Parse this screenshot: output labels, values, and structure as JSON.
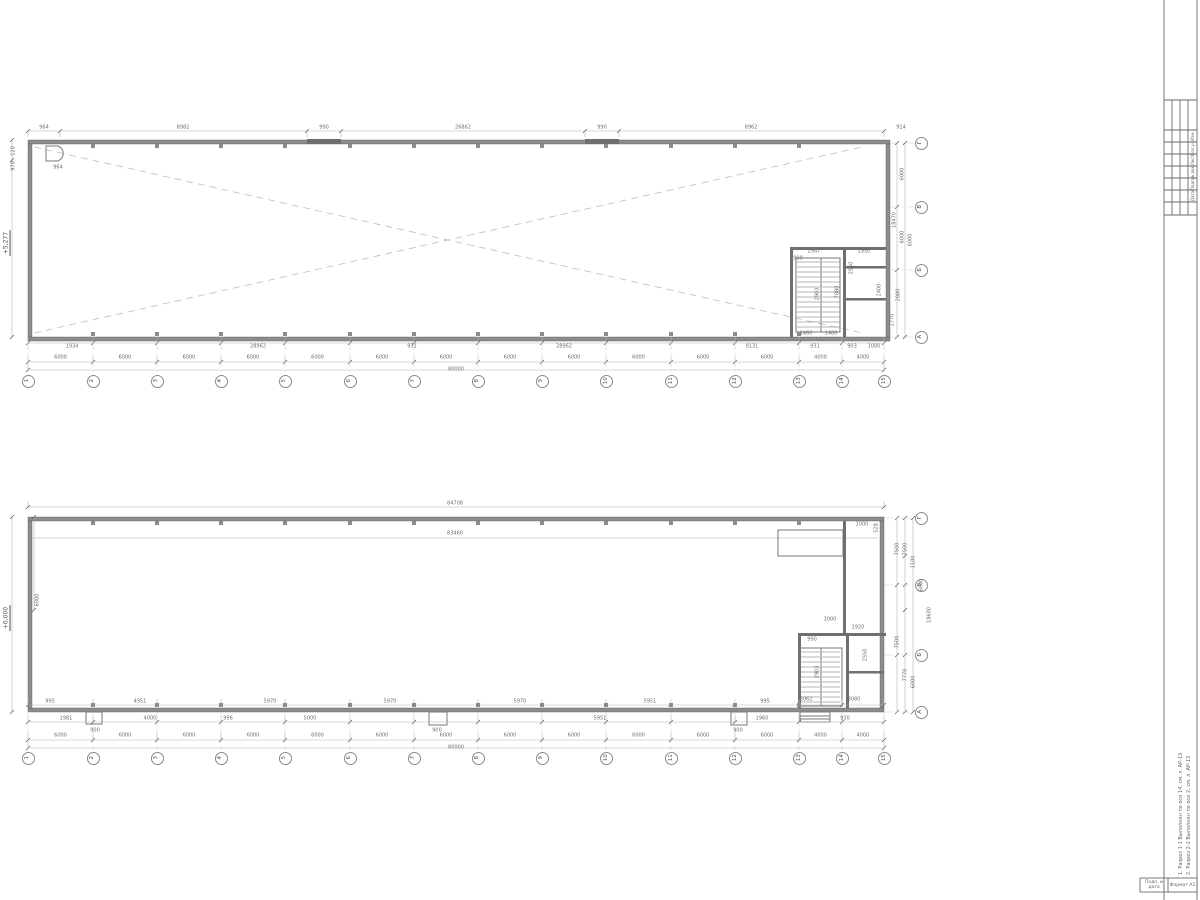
{
  "sheet": {
    "bg": "#ffffff",
    "wall_color": "#8c8c8c",
    "core_wall_color": "#6f6f6f",
    "dim_line_color": "#b3b3b3",
    "dim_text_color": "#6e6e6e",
    "axis_color": "#8a8a8a",
    "dash_color": "#bdbdbd"
  },
  "plans": [
    {
      "name": "plan-upper",
      "elevation": "+5,277",
      "elev_x": 7,
      "elev_y": 243,
      "wall_bottom": 341,
      "wall_right": 890,
      "axes_x": {
        "labels": [
          "1",
          "2",
          "3",
          "4",
          "5",
          "6",
          "7",
          "8",
          "9",
          "10",
          "11",
          "12",
          "13",
          "14",
          "15"
        ],
        "x": [
          28,
          93,
          157,
          221,
          285,
          350,
          414,
          478,
          542,
          606,
          671,
          735,
          799,
          842,
          884
        ],
        "bubble_y": 381
      },
      "axes_y": {
        "labels": [
          "Г",
          "В",
          "Б",
          "А"
        ],
        "y": [
          143,
          207,
          270,
          337
        ],
        "bubble_x": 921
      },
      "span_dims": [
        "6000",
        "6000",
        "6000",
        "6000",
        "6000",
        "6000",
        "6000",
        "6000",
        "6000",
        "6000",
        "6000",
        "6000",
        "4000",
        "4000"
      ],
      "span_y": 362,
      "stairs": {
        "x1": 797,
        "x2": 840,
        "xm": 821,
        "y1": 262,
        "y2": 330,
        "step": 5
      },
      "pilasters": {
        "idx": [
          1,
          2,
          3,
          4,
          5,
          6,
          7,
          8,
          9,
          10,
          11,
          12
        ],
        "top_y": 144,
        "bot_y": 332
      },
      "hrows": [
        {
          "y": 131,
          "xs": [
            28,
            60,
            307,
            341,
            585,
            619,
            884
          ]
        },
        {
          "y": 343,
          "xs": "AX"
        },
        {
          "y": 362,
          "xs": "AX"
        },
        {
          "y": 370,
          "xs": [
            28,
            884
          ]
        }
      ],
      "vrows": [
        {
          "x": 897,
          "ys": [
            143,
            207,
            270,
            337
          ]
        },
        {
          "x": 905,
          "ys": [
            143,
            337
          ]
        },
        {
          "x": 12,
          "ys": [
            140,
            160,
            337
          ]
        }
      ],
      "texts": [
        {
          "x": 44,
          "y": 128,
          "t": "964"
        },
        {
          "x": 183,
          "y": 128,
          "t": "8982"
        },
        {
          "x": 324,
          "y": 128,
          "t": "990"
        },
        {
          "x": 463,
          "y": 128,
          "t": "26862"
        },
        {
          "x": 602,
          "y": 128,
          "t": "990"
        },
        {
          "x": 751,
          "y": 128,
          "t": "8962"
        },
        {
          "x": 901,
          "y": 128,
          "t": "914"
        },
        {
          "x": 72,
          "y": 347,
          "t": "1934"
        },
        {
          "x": 258,
          "y": 347,
          "t": "28962"
        },
        {
          "x": 412,
          "y": 347,
          "t": "931"
        },
        {
          "x": 564,
          "y": 347,
          "t": "28962"
        },
        {
          "x": 752,
          "y": 347,
          "t": "9131"
        },
        {
          "x": 815,
          "y": 347,
          "t": "931"
        },
        {
          "x": 852,
          "y": 347,
          "t": "903"
        },
        {
          "x": 874,
          "y": 347,
          "t": "1000"
        },
        {
          "x": 456,
          "y": 370,
          "t": "80000"
        },
        {
          "x": 814,
          "y": 252,
          "t": "2947"
        },
        {
          "x": 798,
          "y": 259,
          "t": "990"
        },
        {
          "x": 864,
          "y": 252,
          "t": "1950"
        },
        {
          "x": 806,
          "y": 334,
          "t": "1460"
        },
        {
          "x": 831,
          "y": 334,
          "t": "1480"
        },
        {
          "x": 818,
          "y": 294,
          "t": "2903",
          "r": true
        },
        {
          "x": 852,
          "y": 268,
          "t": "2550",
          "r": true
        },
        {
          "x": 880,
          "y": 290,
          "t": "2400",
          "r": true
        },
        {
          "x": 838,
          "y": 292,
          "t": "7080",
          "r": true
        },
        {
          "x": 903,
          "y": 174,
          "t": "6000",
          "r": true
        },
        {
          "x": 903,
          "y": 237,
          "t": "6000",
          "r": true
        },
        {
          "x": 911,
          "y": 240,
          "t": "6000",
          "r": true
        },
        {
          "x": 895,
          "y": 220,
          "t": "18470",
          "r": true
        },
        {
          "x": 899,
          "y": 295,
          "t": "2880",
          "r": true
        },
        {
          "x": 893,
          "y": 320,
          "t": "2770",
          "r": true
        },
        {
          "x": 14,
          "y": 151,
          "t": "120",
          "r": true
        },
        {
          "x": 14,
          "y": 166,
          "t": "970",
          "r": true
        },
        {
          "x": 58,
          "y": 168,
          "t": "964"
        }
      ]
    },
    {
      "name": "plan-lower",
      "elevation": "+0,000",
      "elev_x": 7,
      "elev_y": 618,
      "wall_bottom": 712,
      "wall_right": 884,
      "axes_x": {
        "labels": [
          "1",
          "2",
          "3",
          "4",
          "5",
          "6",
          "7",
          "8",
          "9",
          "10",
          "11",
          "12",
          "13",
          "14",
          "15"
        ],
        "x": [
          28,
          93,
          157,
          221,
          285,
          350,
          414,
          478,
          542,
          606,
          671,
          735,
          799,
          842,
          884
        ],
        "bubble_y": 758
      },
      "axes_y": {
        "labels": [
          "Г",
          "В",
          "Б",
          "А"
        ],
        "y": [
          518,
          585,
          655,
          712
        ],
        "bubble_x": 921
      },
      "span_dims": [
        "6000",
        "6000",
        "6000",
        "6000",
        "6000",
        "6000",
        "6000",
        "6000",
        "6000",
        "6000",
        "6000",
        "6000",
        "4000",
        "4000"
      ],
      "span_y": 740,
      "stairs": {
        "x1": 801,
        "x2": 840,
        "xm": 821,
        "y1": 652,
        "y2": 702,
        "step": 5
      },
      "pilasters": {
        "idx": [
          1,
          2,
          3,
          4,
          5,
          6,
          7,
          8,
          9,
          10,
          11,
          12
        ],
        "top_y": 521,
        "bot_y": 703
      },
      "hrows": [
        {
          "y": 507,
          "xs": [
            28,
            884
          ]
        },
        {
          "y": 705,
          "xs": "AX"
        },
        {
          "y": 722,
          "xs": "AX"
        },
        {
          "y": 740,
          "xs": "AX"
        },
        {
          "y": 748,
          "xs": [
            28,
            884
          ]
        }
      ],
      "vrows": [
        {
          "x": 897,
          "ys": [
            518,
            585,
            655,
            712
          ]
        },
        {
          "x": 905,
          "ys": [
            518,
            556,
            585,
            610,
            655,
            712
          ]
        },
        {
          "x": 913,
          "ys": [
            518,
            712
          ]
        },
        {
          "x": 12,
          "ys": [
            517,
            712
          ]
        },
        {
          "x": 34,
          "ys": [
            517,
            610
          ]
        }
      ],
      "texts": [
        {
          "x": 455,
          "y": 504,
          "t": "84708"
        },
        {
          "x": 455,
          "y": 534,
          "t": "83460"
        },
        {
          "x": 877,
          "y": 528,
          "t": "528",
          "r": true
        },
        {
          "x": 862,
          "y": 525,
          "t": "1000"
        },
        {
          "x": 898,
          "y": 549,
          "t": "7500",
          "r": true
        },
        {
          "x": 906,
          "y": 549,
          "t": "7500",
          "r": true
        },
        {
          "x": 914,
          "y": 562,
          "t": "1100",
          "r": true
        },
        {
          "x": 922,
          "y": 585,
          "t": "6000",
          "r": true
        },
        {
          "x": 930,
          "y": 615,
          "t": "18600",
          "r": true
        },
        {
          "x": 898,
          "y": 642,
          "t": "7500",
          "r": true
        },
        {
          "x": 906,
          "y": 675,
          "t": "7770",
          "r": true
        },
        {
          "x": 914,
          "y": 682,
          "t": "6000",
          "r": true
        },
        {
          "x": 806,
          "y": 700,
          "t": "3062"
        },
        {
          "x": 854,
          "y": 700,
          "t": "3080"
        },
        {
          "x": 830,
          "y": 620,
          "t": "1000"
        },
        {
          "x": 812,
          "y": 640,
          "t": "990"
        },
        {
          "x": 858,
          "y": 628,
          "t": "1920"
        },
        {
          "x": 818,
          "y": 672,
          "t": "2903",
          "r": true
        },
        {
          "x": 866,
          "y": 655,
          "t": "2550",
          "r": true
        },
        {
          "x": 38,
          "y": 600,
          "t": "6000",
          "r": true
        },
        {
          "x": 50,
          "y": 702,
          "t": "995"
        },
        {
          "x": 140,
          "y": 702,
          "t": "4951"
        },
        {
          "x": 270,
          "y": 702,
          "t": "5970"
        },
        {
          "x": 390,
          "y": 702,
          "t": "5970"
        },
        {
          "x": 520,
          "y": 702,
          "t": "5970"
        },
        {
          "x": 650,
          "y": 702,
          "t": "5951"
        },
        {
          "x": 765,
          "y": 702,
          "t": "995"
        },
        {
          "x": 66,
          "y": 719,
          "t": "1981"
        },
        {
          "x": 150,
          "y": 719,
          "t": "4000"
        },
        {
          "x": 228,
          "y": 719,
          "t": "996"
        },
        {
          "x": 310,
          "y": 719,
          "t": "5000"
        },
        {
          "x": 600,
          "y": 719,
          "t": "5951"
        },
        {
          "x": 762,
          "y": 719,
          "t": "1960"
        },
        {
          "x": 845,
          "y": 719,
          "t": "930"
        },
        {
          "x": 95,
          "y": 731,
          "t": "900"
        },
        {
          "x": 437,
          "y": 731,
          "t": "900"
        },
        {
          "x": 738,
          "y": 731,
          "t": "900"
        },
        {
          "x": 456,
          "y": 748,
          "t": "80000"
        }
      ]
    }
  ],
  "frame": {
    "rev_labels": [
      "Изм.",
      "Кол.уч.",
      "Лист",
      "№ док.",
      "Подп.",
      "Дата"
    ],
    "rev_x": 1193,
    "rev_y": [
      136,
      148,
      160,
      172,
      184,
      196
    ],
    "notes": [
      "1. Разрез 1-1 Выполнен по оси 14, см. л. АР-13",
      "2. Разрез 2-2 Выполнен по оси 2, см. л. АР-13"
    ],
    "footer_left": "Подп. и дата",
    "footer_right": "Формат А1"
  }
}
